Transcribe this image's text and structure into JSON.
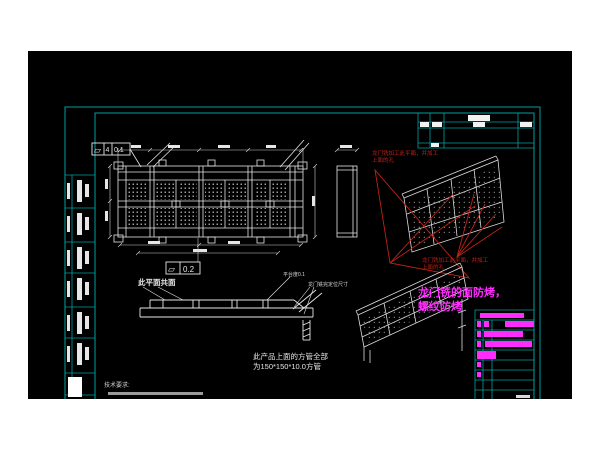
{
  "colors": {
    "background": "#000000",
    "page": "#ffffff",
    "frame": "#00a0a0",
    "line": "#e6e6e6",
    "red": "#bf2218",
    "magenta": "#ff2bff"
  },
  "annotations": {
    "red_note_line1": "龙门铣加工此平面，并加工",
    "red_note_line2": "上面的孔",
    "magenta_note_line1": "龙门铣的面防烤，",
    "magenta_note_line2": "螺纹防烤",
    "coplanar_note": "此平面共面",
    "platform_flatness_note": "平台度0.1",
    "gantry_mill_dim_note": "龙门铣完定位尺寸",
    "product_note_line1": "此产品上面的方管全部",
    "product_note_line2": "为150*150*10.0方管",
    "tech_req_title": "技术要求:"
  },
  "gdt": {
    "flatness_symbol": "⏥",
    "box1_datum": "4",
    "box1_value": "0.1",
    "box2_value": "0.2"
  },
  "title_block": {
    "header_bar": [
      452,
      262,
      44,
      5
    ],
    "rows": [
      {
        "y": 270,
        "bars": [
          [
            449,
            4,
            6
          ],
          [
            456,
            5,
            6
          ],
          [
            477,
            29,
            6
          ]
        ]
      },
      {
        "y": 280,
        "bars": [
          [
            449,
            4,
            6
          ],
          [
            456,
            39,
            6
          ]
        ]
      },
      {
        "y": 290,
        "bars": [
          [
            449,
            4,
            6
          ],
          [
            457,
            47,
            6
          ]
        ]
      },
      {
        "y": 300,
        "bars": [
          [
            449,
            19,
            8
          ]
        ]
      },
      {
        "y": 311,
        "bars": [
          [
            449,
            4,
            5
          ]
        ]
      },
      {
        "y": 321,
        "bars": [
          [
            449,
            4,
            5
          ]
        ]
      }
    ]
  },
  "bom_strip": {
    "rows_y": [
      124,
      157,
      191,
      222,
      256,
      287,
      322
    ],
    "bottom_y": 344,
    "solid_block": [
      40,
      326,
      14,
      20
    ]
  }
}
